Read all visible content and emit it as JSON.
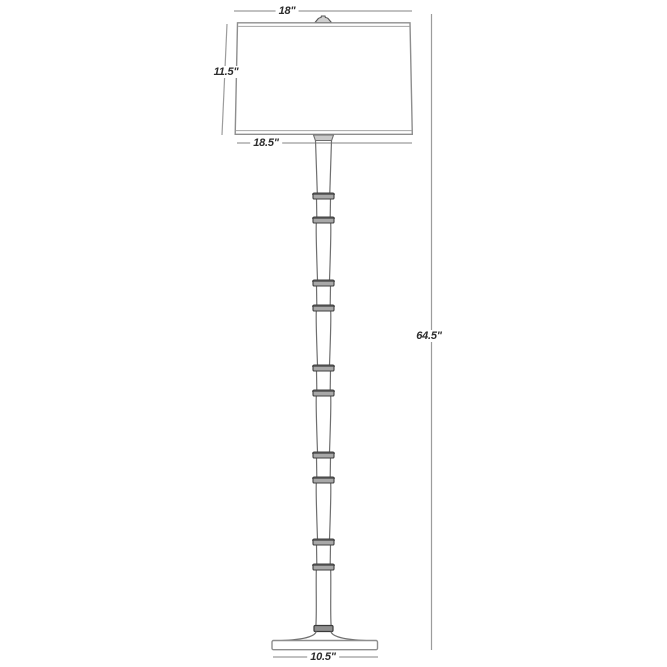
{
  "diagram": {
    "title": "Floor lamp dimension drawing",
    "labels": {
      "shade_top_width": "18\"",
      "shade_height": "11.5\"",
      "shade_bottom_width": "18.5\"",
      "overall_height": "64.5\"",
      "base_width": "10.5\""
    },
    "style": {
      "background": "#ffffff",
      "dimension_line_color": "#9c9c9c",
      "artwork_line_color": "#6f6f6f",
      "shade_line_color": "#8e8e8e",
      "node_fill_color": "#a8a8a8",
      "node_stroke_color": "#3f3f3f",
      "label_text_color": "#2d2d2d"
    }
  }
}
